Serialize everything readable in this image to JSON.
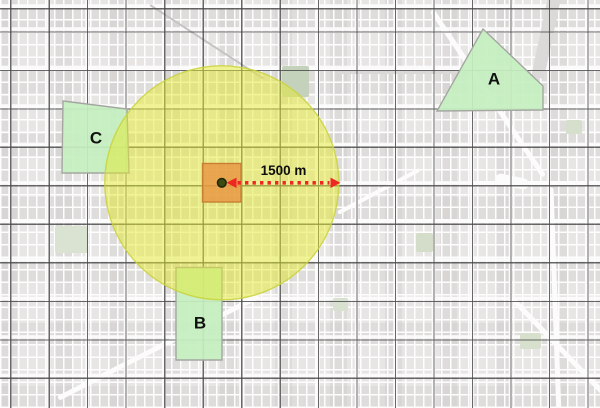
{
  "map": {
    "annotation": {
      "distance_label": "1500 m"
    },
    "buffer": {
      "cx": 221.8,
      "cy": 182.8,
      "radius": 117,
      "fill": "#e3e92e",
      "fill_opacity": 0.5,
      "stroke": "#c9d23c",
      "stroke_opacity": 0.85
    },
    "center_cell": {
      "x": 202.5,
      "y": 163.5,
      "size": 38.5,
      "fill": "#e89440",
      "fill_opacity": 0.8,
      "stroke": "#c97f33"
    },
    "center_point": {
      "cx": 221.8,
      "cy": 182.8,
      "r": 4.3,
      "fill": "#3d4b11",
      "stroke": "#20290a"
    },
    "arrow": {
      "y": 182.8,
      "tip_left_x": 226.5,
      "tip_right_x": 340.5,
      "head_len": 10,
      "head_half_h": 5.2,
      "color": "#ee2722",
      "dash": "3.4 4.1",
      "width": 3.6
    },
    "sites": {
      "fill": "#c5efc0",
      "fill_opacity": 0.93,
      "stroke": "#a3a7a0",
      "items": [
        {
          "label": "A",
          "points": "483,29 543,86 543,110 437,111",
          "lx": 494,
          "ly": 79
        },
        {
          "label": "B",
          "points": "176,267.5 222,267.5 222,360 176,360",
          "lx": 200,
          "ly": 323
        },
        {
          "label": "C",
          "points": "63,101 127,109 129,173 62,173",
          "lx": 96,
          "ly": 138
        }
      ]
    }
  }
}
